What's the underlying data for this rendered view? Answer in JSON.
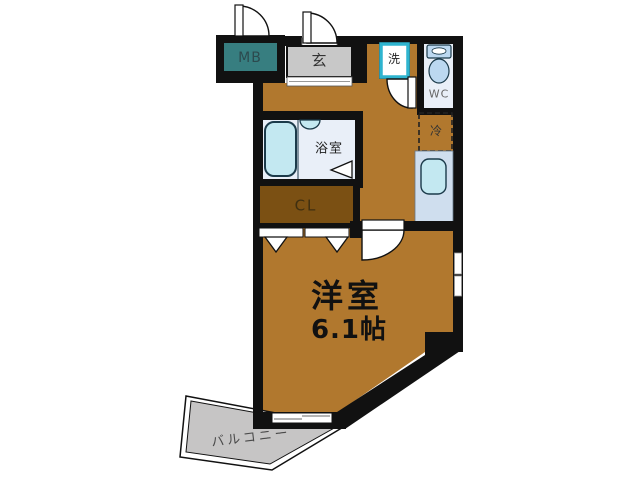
{
  "floorplan": {
    "unit_labels": {
      "meter_box": "MB",
      "entrance": "玄",
      "washing_machine": "洗",
      "toilet": "WC",
      "refrigerator": "冷",
      "bathroom": "浴室",
      "closet": "CL",
      "main_room": "洋室",
      "main_room_size": "6.1帖",
      "balcony": "バルコニー"
    },
    "colors": {
      "wall": "#111111",
      "floor": "#b1782e",
      "closet_floor": "#7b5013",
      "meter_box": "#377e80",
      "entrance_floor": "#c8c8c8",
      "wet_area_floor": "#e9eff8",
      "kitchen_floor": "#cfdeee",
      "fixture": "#c3e8f1",
      "toilet_fixture": "#bcd8f0",
      "washer_outline": "#2eb4cf",
      "balcony_floor": "#c6c5c5",
      "door_arc": "#ffffff"
    }
  }
}
